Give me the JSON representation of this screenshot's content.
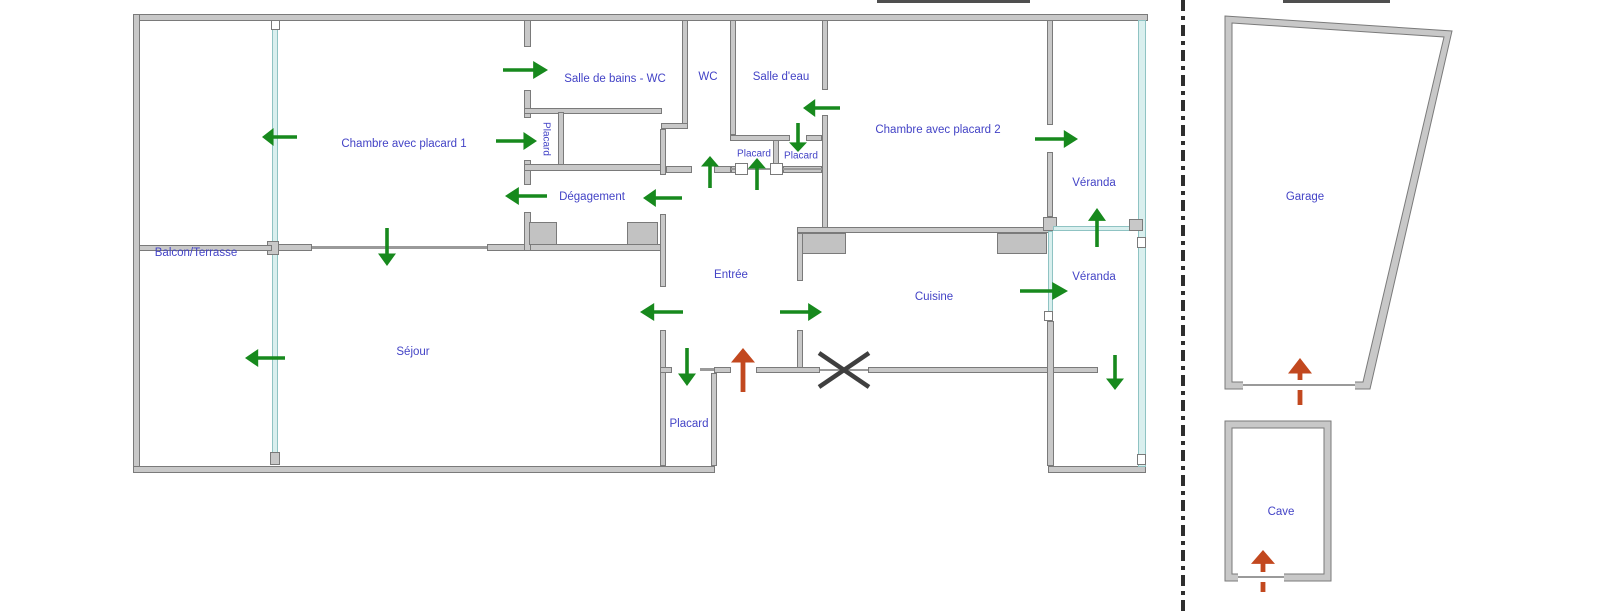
{
  "diagram_type": "apartment floor plan",
  "rooms": {
    "balcon": "Balcon/Terrasse",
    "chambre1": "Chambre avec placard 1",
    "salle_de_bains": "Salle de bains - WC",
    "wc": "WC",
    "salle_eau": "Salle d'eau",
    "chambre2": "Chambre avec placard 2",
    "veranda_haut": "Véranda",
    "veranda_bas": "Véranda",
    "degagement": "Dégagement",
    "placard_chambre1": "Placard",
    "placard_couloir_1": "Placard",
    "placard_couloir_2": "Placard",
    "entree": "Entrée",
    "cuisine": "Cuisine",
    "sejour": "Séjour",
    "placard_entree": "Placard",
    "garage": "Garage",
    "cave": "Cave"
  },
  "colors": {
    "door_arrow": "#17891d",
    "entrance_arrow": "#c2481f",
    "glass_wall": "#d9efee",
    "wall_fill": "#c8c8c8",
    "wall_edge": "#7a7a7a",
    "label_text": "#4343c6",
    "condemned_x": "#3f3f3f",
    "separator": "#2e2e2e"
  },
  "icons": {
    "door_swing_arrow": "green-arrow",
    "main_entrance_arrow": "red-arrow",
    "condemned_opening": "x-mark",
    "property_separator": "dash-dot-line",
    "window_junction": "white-square"
  }
}
